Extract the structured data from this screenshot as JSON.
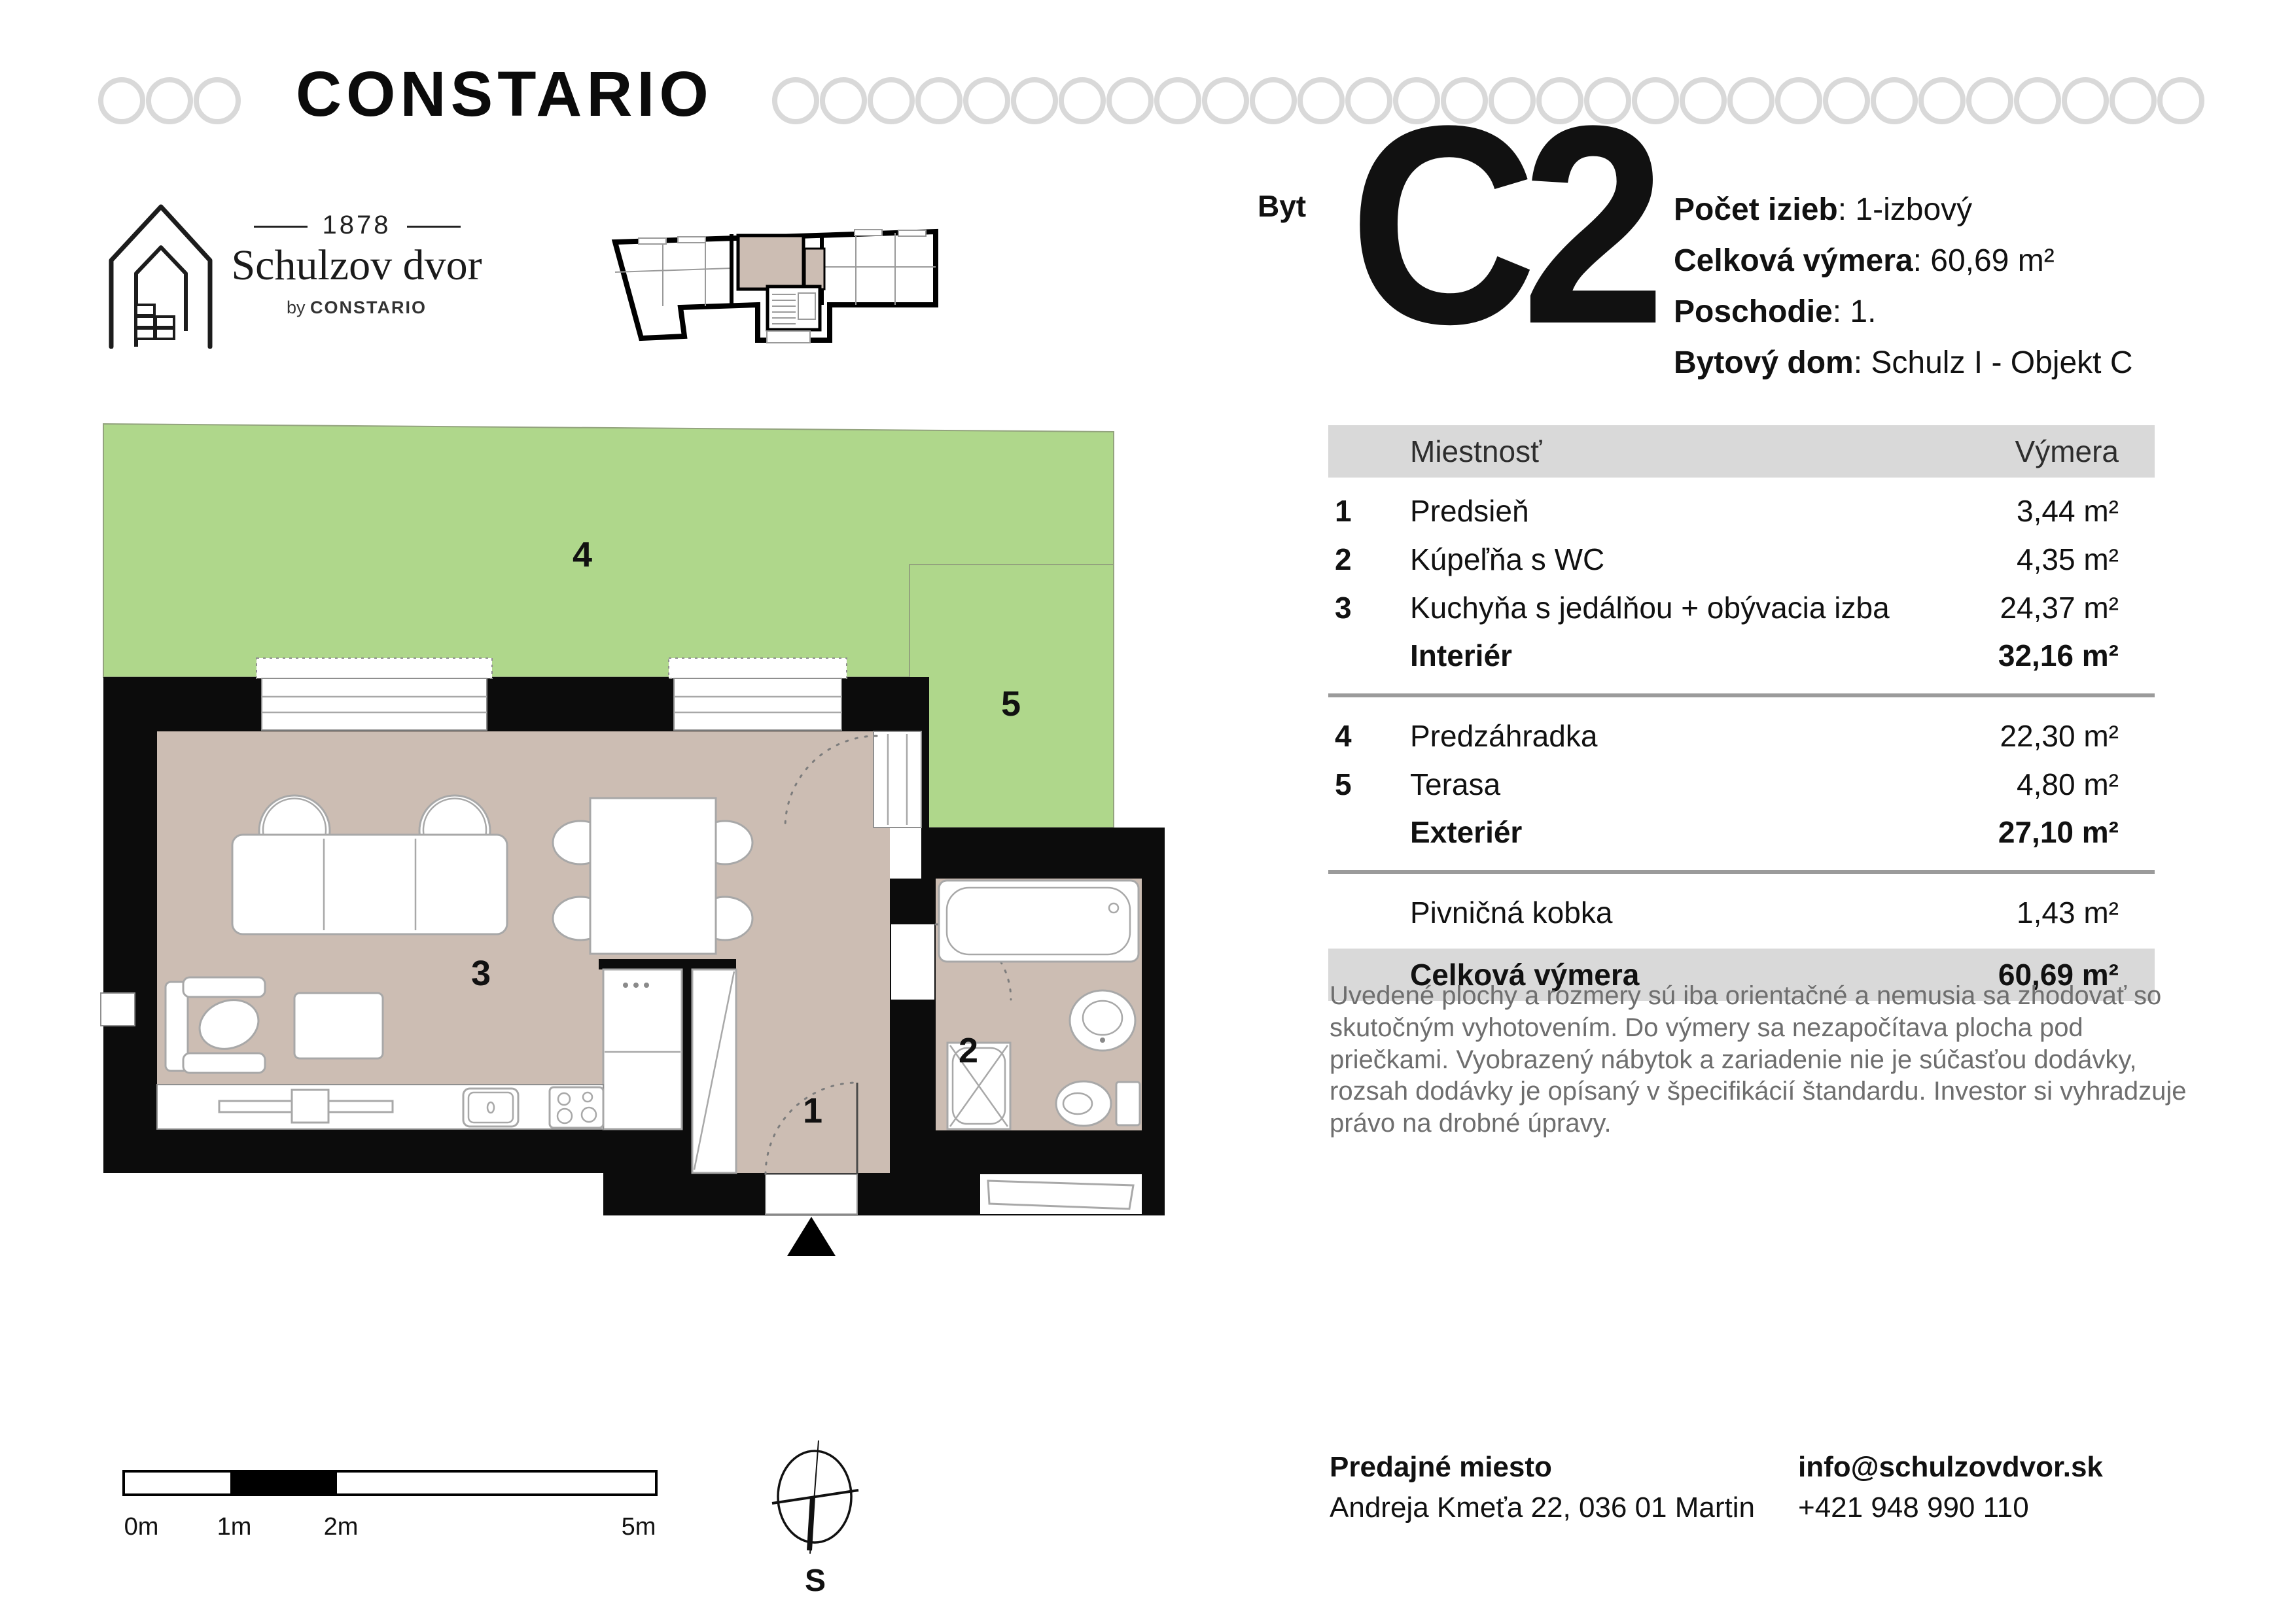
{
  "colors": {
    "green": "#afd78b",
    "beige": "#ccbdb3",
    "wall": "#0c0c0c",
    "band": "#d9d9d9",
    "ring": "#d9d9d9",
    "muted": "#6e6e6e",
    "furnstroke": "#a8a8a8"
  },
  "brand": {
    "name": "CONSTARIO"
  },
  "logo": {
    "year": "1878",
    "name": "Schulzov dvor",
    "by_prefix": "by ",
    "by_brand": "CONSTARIO"
  },
  "unit": {
    "label": "Byt",
    "code": "C2",
    "details": [
      {
        "label": "Počet izieb",
        "value": "1-izbový"
      },
      {
        "label": "Celková výmera",
        "value": "60,69 m²"
      },
      {
        "label": "Poschodie",
        "value": "1."
      },
      {
        "label": "Bytový dom",
        "value": "Schulz I - Objekt C"
      }
    ]
  },
  "table": {
    "columns": [
      "Miestnosť",
      "Výmera"
    ],
    "rows": [
      {
        "num": "1",
        "name": "Predsieň",
        "area": "3,44 m²"
      },
      {
        "num": "2",
        "name": "Kúpeľňa s WC",
        "area": "4,35 m²"
      },
      {
        "num": "3",
        "name": "Kuchyňa s jedálňou + obývacia izba",
        "area": "24,37 m²"
      }
    ],
    "interior": {
      "name": "Interiér",
      "area": "32,16 m²"
    },
    "rows2": [
      {
        "num": "4",
        "name": "Predzáhradka",
        "area": "22,30 m²"
      },
      {
        "num": "5",
        "name": "Terasa",
        "area": "4,80 m²"
      }
    ],
    "exterior": {
      "name": "Exteriér",
      "area": "27,10 m²"
    },
    "cellar": {
      "name": "Pivničná kobka",
      "area": "1,43 m²"
    },
    "total": {
      "name": "Celková výmera",
      "area": "60,69 m²"
    }
  },
  "disclaimer": "Uvedené plochy a rozmery sú iba orientačné a nemusia sa zhodovať so skutočným vyhotovením. Do výmery sa nezapočítava plocha pod priečkami. Vyobrazený nábytok a zariadenie nie je súčasťou dodávky, rozsah dodávky je opísaný v špecifikácií štandardu. Investor si vyhradzuje právo na drobné úpravy.",
  "plan": {
    "labels": {
      "r1": "1",
      "r2": "2",
      "r3": "3",
      "r4": "4",
      "r5": "5"
    }
  },
  "scalebar": {
    "labels": [
      "0m",
      "1m",
      "2m",
      "5m"
    ]
  },
  "compass": {
    "south": "S"
  },
  "footer": {
    "sales_label": "Predajné miesto",
    "sales_address": "Andreja Kmeťa 22, 036 01 Martin",
    "email": "info@schulzovdvor.sk",
    "phone": "+421 948 990 110"
  }
}
